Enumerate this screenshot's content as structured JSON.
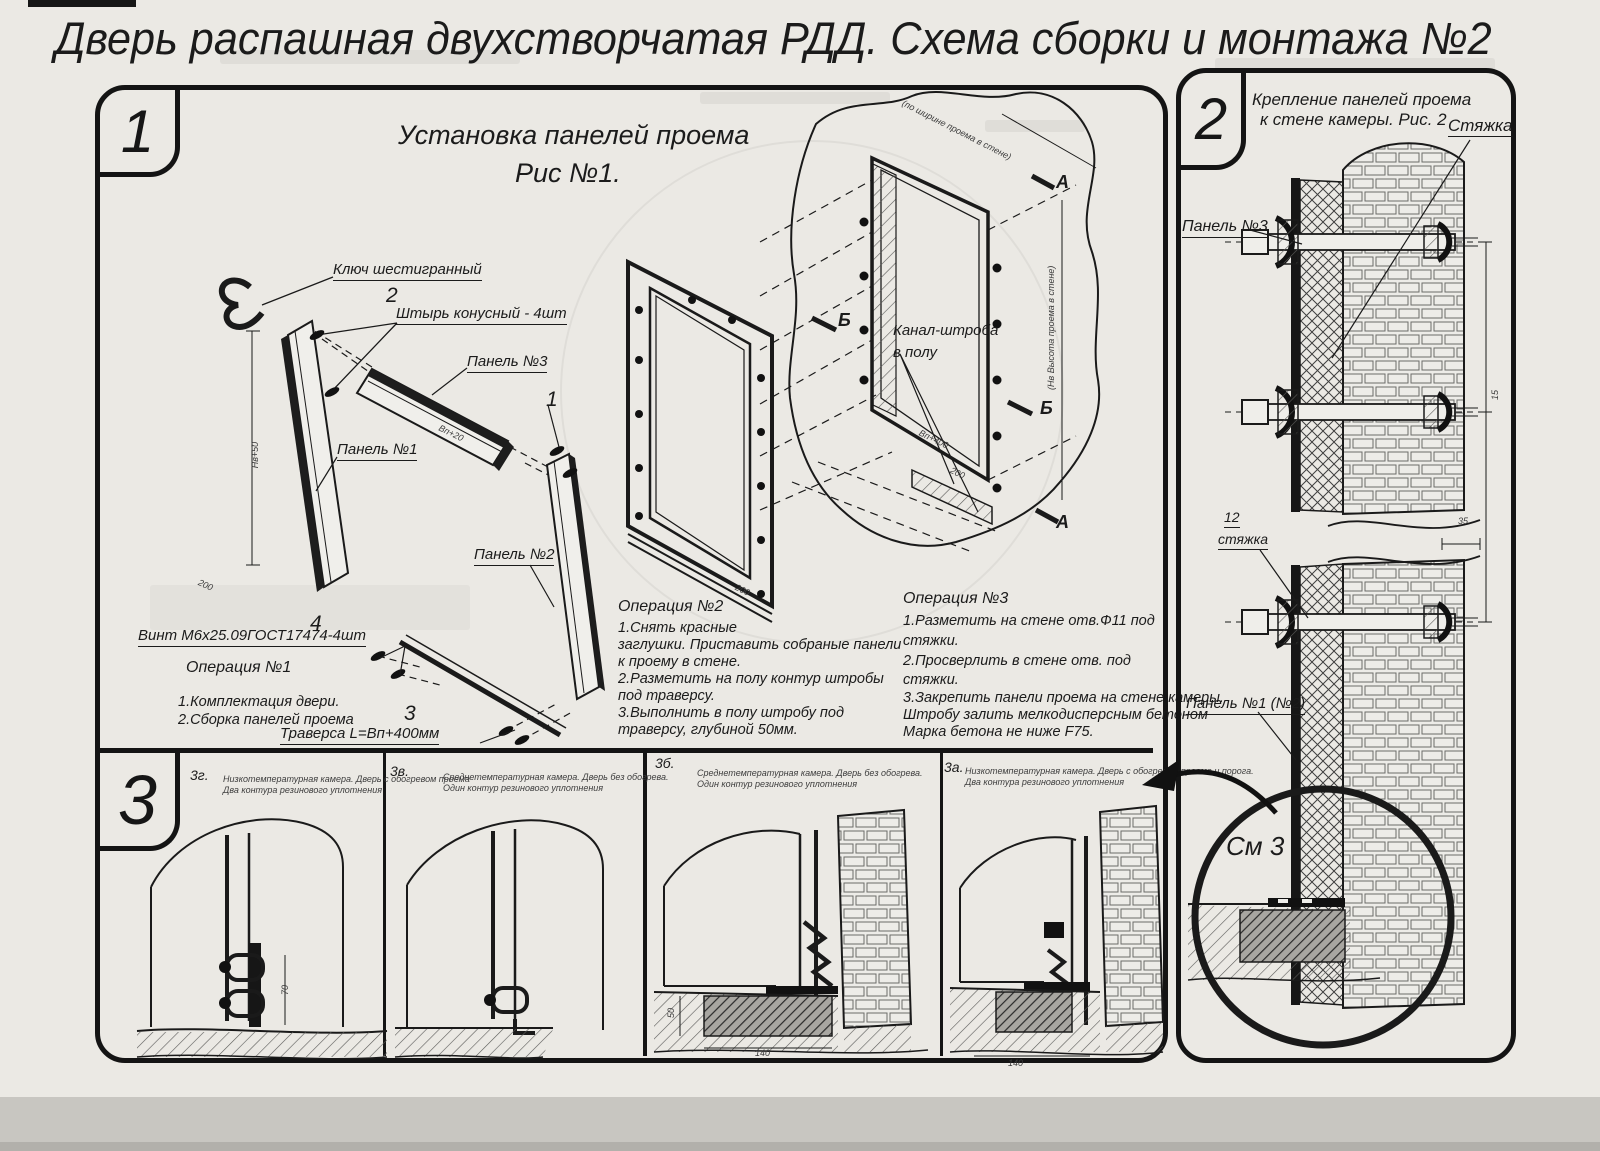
{
  "title": "Дверь распашная двухстворчатая РДД.  Схема сборки и монтажа №2",
  "fig1": {
    "badge": "1",
    "caption1": "Установка панелей проема",
    "caption2": "Рис №1.",
    "labels": {
      "hex_key": "Ключ шестигранный",
      "pin_no": "2",
      "pin": "Штырь конусный - 4шт",
      "panel3": "Панель №3",
      "one": "1",
      "panel1": "Панель №1",
      "panel2": "Панель №2",
      "screw_no": "4",
      "screw": "Винт М6х25.09ГОСТ17474-4шт",
      "trav_no": "3",
      "traverse": "Траверса  L=Вп+400мм",
      "channel1": "Канал-штроба",
      "channel2": "в полу"
    },
    "ops": {
      "op1": {
        "title": "Операция №1",
        "lines": [
          "1.Комплектация двери.",
          "2.Сборка панелей проема"
        ]
      },
      "op2": {
        "title": "Операция №2",
        "lines": [
          "1.Снять красные",
          "заглушки. Приставить собраные панели",
          "к проему в стене.",
          "2.Разметить на полу контур штробы",
          "под траверсу.",
          "3.Выполнить в полу штробу под",
          "траверсу, глубиной 50мм."
        ]
      },
      "op3": {
        "title": "Операция №3",
        "lines": [
          "1.Разметить на стене отв.Ф11 под",
          "стяжки.",
          "2.Просверлить в стене отв.   под",
          "стяжки.",
          "3.Закрепить панели проема на стене камеры.",
          "Штробу залить мелкодисперсным бетоном",
          "Марка бетона не ниже   F75."
        ]
      }
    },
    "marks": {
      "a": "А",
      "b": "Б"
    },
    "dims": {
      "nv50": "Нв+50",
      "vp20": "Вп+20",
      "d200": "200",
      "vp400": "Вп+400",
      "width_note": "(по ширине проема в стене)",
      "height_note": "(Нв Высота проема в стене)"
    }
  },
  "fig2": {
    "badge": "2",
    "caption1": "Крепление панелей проема",
    "caption2": "к стене камеры. Рис. 2",
    "labels": {
      "tie": "Стяжка",
      "panel3": "Панель №3",
      "tie_no": "12",
      "tie2": "стяжка",
      "panel12": "Панель №1 (№2)",
      "see": "См 3"
    },
    "dims": {
      "d35": "35",
      "d15": "15"
    }
  },
  "fig3": {
    "badge": "3",
    "items": [
      {
        "id": "3г.",
        "line1": "Низкотемпературная камера. Дверь с обогревом проема",
        "line2": "Два контура резинового уплотнения"
      },
      {
        "id": "3в.",
        "line1": "Среднетемпературная камера. Дверь без обогрева.",
        "line2": "Один контур резинового уплотнения"
      },
      {
        "id": "3б.",
        "line1": "Среднетемпературная камера. Дверь без обогрева.",
        "line2": "Один контур резинового уплотнения"
      },
      {
        "id": "3а.",
        "line1": "Низкотемпературная камера. Дверь с обогревом проема и порога.",
        "line2": "Два контура резинового уплотнения"
      }
    ],
    "dims": {
      "d70": "70",
      "d50": "50",
      "d140": "140"
    }
  }
}
